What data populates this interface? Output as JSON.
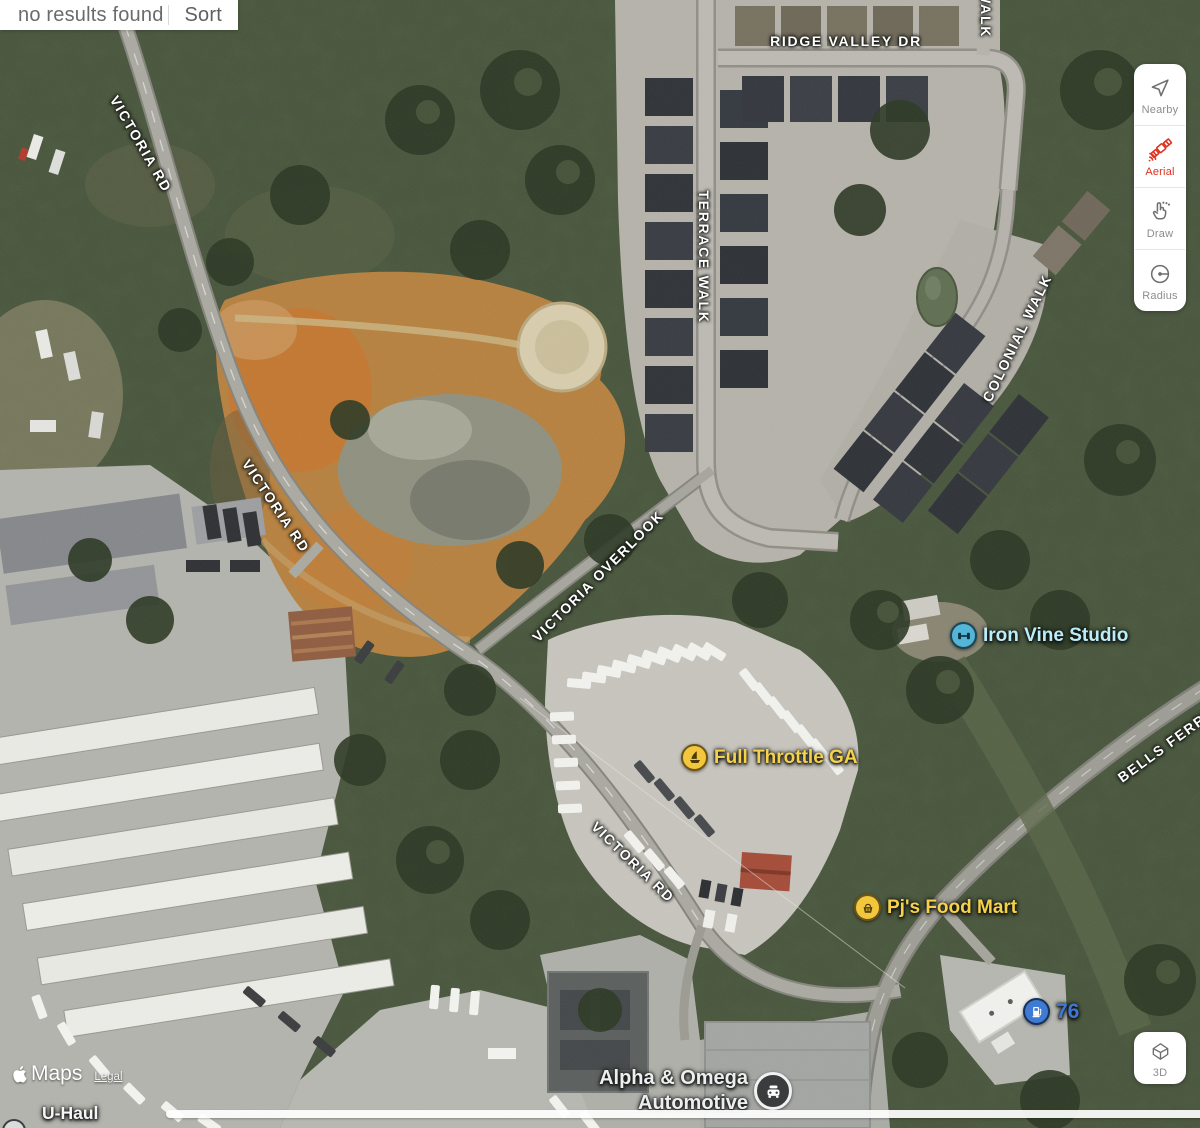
{
  "results_bar": {
    "status_text": "no results found",
    "sort_label": "Sort"
  },
  "tool_panel": {
    "items": [
      {
        "label": "Nearby",
        "icon": "navigation-arrow-icon",
        "active": false
      },
      {
        "label": "Aerial",
        "icon": "satellite-icon",
        "active": true
      },
      {
        "label": "Draw",
        "icon": "pointing-hand-icon",
        "active": false
      },
      {
        "label": "Radius",
        "icon": "radius-tool-icon",
        "active": false
      }
    ],
    "active_color": "#df321f",
    "inactive_color": "#6f6f6f"
  },
  "view_controls": {
    "threed_label": "3D",
    "icon": "3d-house-icon"
  },
  "streets": [
    {
      "text": "WALK"
    },
    {
      "text": "RIDGE VALLEY DR"
    },
    {
      "text": "TERRACE WALK"
    },
    {
      "text": "COLONIAL WALK"
    },
    {
      "text": "VICTORIA RD"
    },
    {
      "text": "VICTORIA RD"
    },
    {
      "text": "VICTORIA OVERLOOK"
    },
    {
      "text": "VICTORIA RD"
    },
    {
      "text": "BELLS FERRY"
    }
  ],
  "pois": [
    {
      "name": "Iron Vine Studio",
      "icon": "dumbbell-icon",
      "color": "#bbedf8"
    },
    {
      "name": "Full Throttle GA",
      "icon": "sailboat-icon",
      "color": "#f6d24a"
    },
    {
      "name": "Pj's Food Mart",
      "icon": "shopping-basket-icon",
      "color": "#f6d24a"
    },
    {
      "name": "76",
      "icon": "fuel-pump-icon",
      "color": "#3d78d7"
    },
    {
      "name_line1": "Alpha & Omega",
      "name_line2": "Automotive",
      "icon": "car-repair-icon",
      "color": "#eceef0"
    },
    {
      "name": "U-Haul",
      "icon": "partial-poi-icon",
      "color": "#f5f6f7"
    }
  ],
  "attribution": {
    "logo_icon": "apple-logo-icon",
    "brand": "Maps",
    "legal_label": "Legal"
  },
  "colors": {
    "street_label": "#ffffff",
    "scrollbar": "#ffffff"
  }
}
